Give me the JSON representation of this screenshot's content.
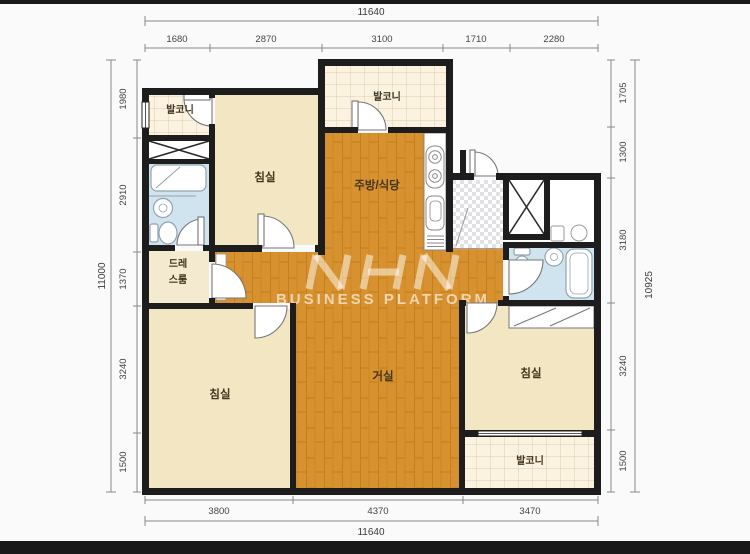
{
  "dims": {
    "top": {
      "total": "11640",
      "segments": [
        "1680",
        "2870",
        "3100",
        "1710",
        "2280"
      ]
    },
    "bottom": {
      "total": "11640",
      "segments": [
        "3800",
        "4370",
        "3470"
      ]
    },
    "left": {
      "total": "11000",
      "segments": [
        "1980",
        "2910",
        "1370",
        "3240",
        "1500"
      ]
    },
    "right": {
      "total": "10925",
      "segments": [
        "1705",
        "1300",
        "3180",
        "3240",
        "1500"
      ]
    }
  },
  "rooms": {
    "balcony_tl": "발코니",
    "balcony_top": "발코니",
    "bedroom_tl": "침실",
    "kitchen": "주방/식당",
    "dress_line1": "드레",
    "dress_line2": "스룸",
    "bedroom_bl": "침실",
    "living": "거실",
    "bedroom_br": "침실",
    "balcony_br": "발코니"
  },
  "watermark": {
    "text": "BUSINESS PLATFORM"
  },
  "colors": {
    "wall": "#1d1d1d",
    "bedroom": "#f2e7c2",
    "dress": "#f4ead0",
    "bath": "#cfe4ee",
    "background": "#fbfafa",
    "letterbox": "#191919"
  }
}
